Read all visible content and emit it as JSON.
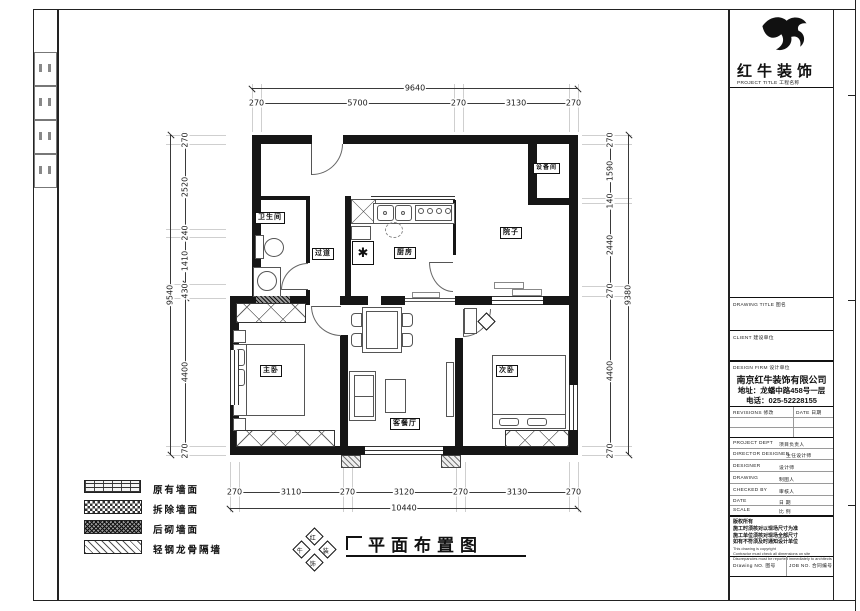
{
  "plan": {
    "rooms": [
      {
        "id": "bathroom",
        "label": "卫生间"
      },
      {
        "id": "corridor",
        "label": "过道"
      },
      {
        "id": "kitchen",
        "label": "厨房"
      },
      {
        "id": "utility",
        "label": "设备间"
      },
      {
        "id": "yard",
        "label": "院子"
      },
      {
        "id": "master-bedroom",
        "label": "主卧"
      },
      {
        "id": "living-dining",
        "label": "客餐厅"
      },
      {
        "id": "second-bedroom",
        "label": "次卧"
      }
    ],
    "shaft_symbol": "✱"
  },
  "dimensions": {
    "top": {
      "overall": "9640",
      "segments": [
        "270",
        "5700",
        "270",
        "3130",
        "270"
      ]
    },
    "bottom": {
      "overall": "10440",
      "segments": [
        "270",
        "3110",
        "270",
        "3120",
        "270",
        "3130",
        "270"
      ]
    },
    "left": {
      "overall": "9540",
      "segments": [
        "270",
        "2520",
        "240",
        "1410",
        "430",
        "4400",
        "270"
      ]
    },
    "right": {
      "overall": "9380",
      "segments": [
        "270",
        "1590",
        "140",
        "2440",
        "270",
        "4400",
        "270"
      ]
    }
  },
  "legend": {
    "items": [
      {
        "label": "原有墙面"
      },
      {
        "label": "拆除墙面"
      },
      {
        "label": "后砌墙面"
      },
      {
        "label": "轻钢龙骨隔墙"
      }
    ]
  },
  "sheet_title": {
    "text": "平面布置图",
    "logo_chars": [
      "红",
      "牛",
      "装",
      "饰"
    ]
  },
  "title_block": {
    "brand": "红牛装饰",
    "brand_sub": "PROJECT TITLE 工程名称",
    "sections": {
      "drawing_title": "DRAWING TITLE 图名",
      "client": "CLIENT 建设单位",
      "design_firm": "DESIGN FIRM 设计单位"
    },
    "company": {
      "name": "南京红牛装饰有限公司",
      "address": "地址：龙蟠中路458号一层",
      "phone": "电话：025-52228155"
    },
    "revisions": {
      "col1": "REVISIONS 修改",
      "col2": "DATE 日期"
    },
    "rows": [
      {
        "en": "PROJECT DEPT",
        "zh": "项目负责人"
      },
      {
        "en": "DIRECTOR DESIGNER",
        "zh": "主任设计师"
      },
      {
        "en": "DESIGNER",
        "zh": "设计师"
      },
      {
        "en": "DRAWING",
        "zh": "制图人"
      },
      {
        "en": "CHECKED BY",
        "zh": "审核人"
      },
      {
        "en": "DATE",
        "zh": "日 期"
      },
      {
        "en": "SCALE",
        "zh": "比 例"
      }
    ],
    "notes": {
      "zh": [
        "版权所有",
        "施工时须核对以现场尺寸为准",
        "施工单位须核对现场全部尺寸",
        "如有不符须及时通知设计单位"
      ],
      "en": [
        "This drawing is copyright",
        "Contractor must check all dimensions on site",
        "Discrepancies must be reported immediately to architects"
      ]
    },
    "footer": {
      "left": "Drawing NO. 图号",
      "right": "JOB NO. 合同编号"
    }
  }
}
